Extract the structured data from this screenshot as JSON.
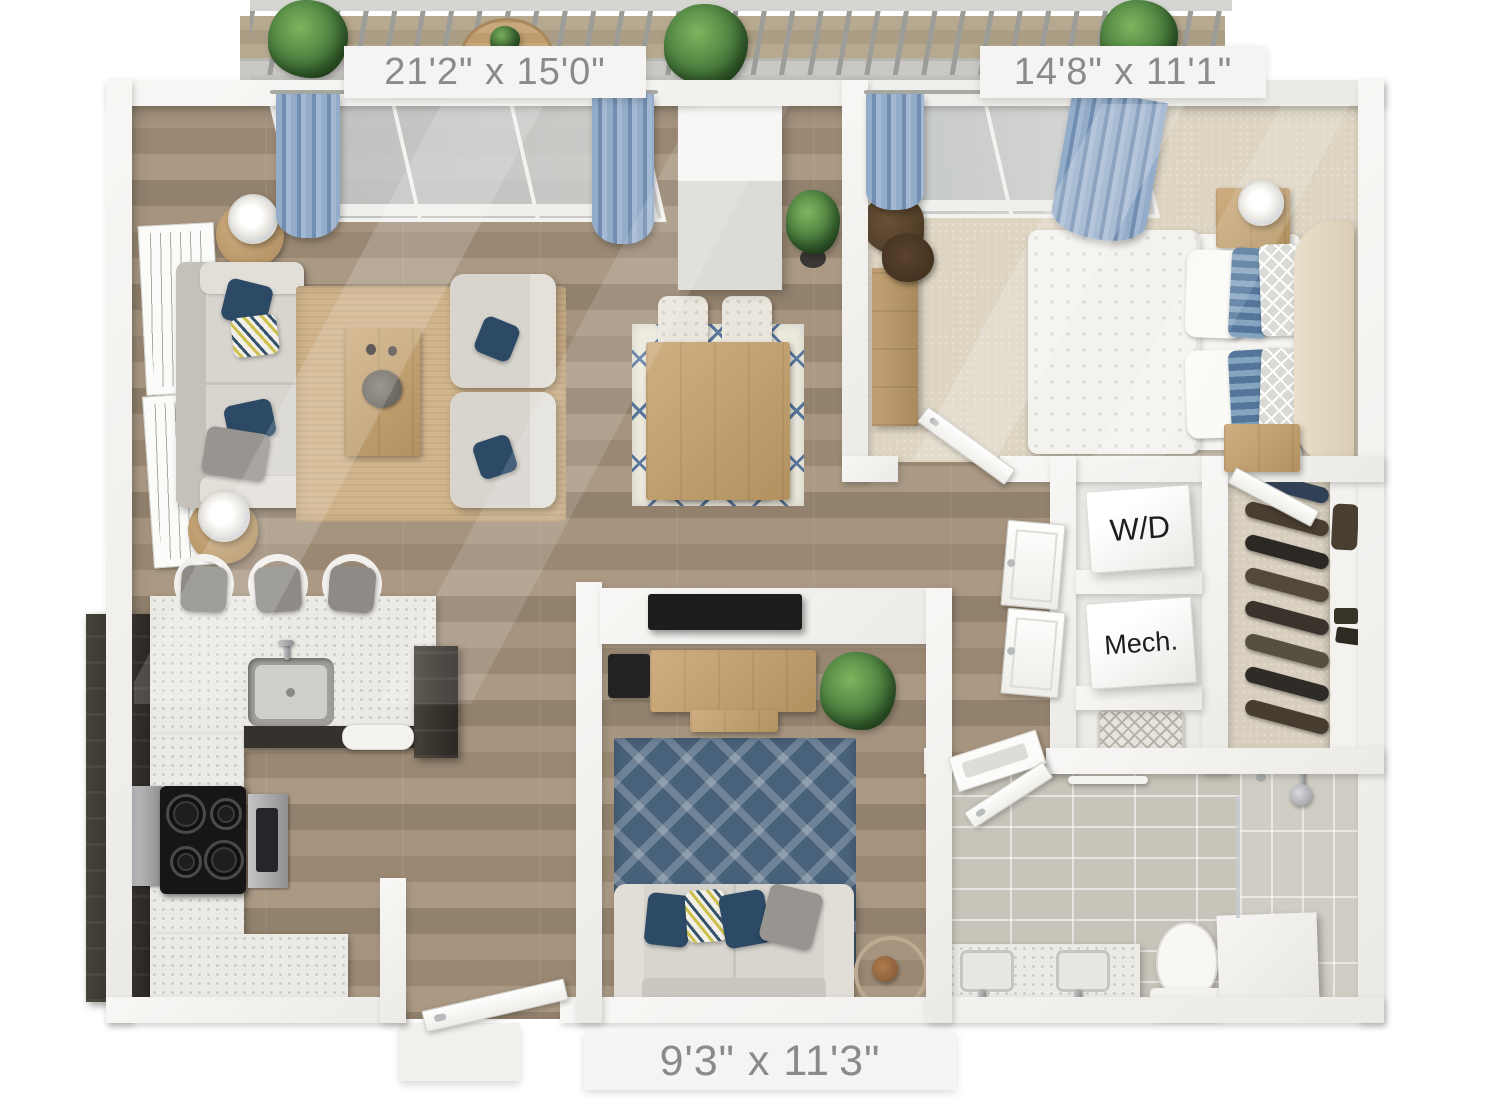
{
  "title": "3D apartment floor plan",
  "labels": {
    "living_room": "21'2\" x 15'0\"",
    "bedroom": "14'8\" x 11'1\"",
    "den": "9'3\" x 11'3\"",
    "washer_dryer": "W/D",
    "mechanical": "Mech."
  },
  "rooms": [
    {
      "name": "balcony",
      "features": [
        "railing",
        "potted-plants",
        "round-table",
        "wood-deck"
      ]
    },
    {
      "name": "living-dining-room",
      "dimensions": "21'2\" x 15'0\"",
      "features": [
        "sofa",
        "armchairs",
        "coffee-table",
        "jute-rug",
        "side-tables-with-lamps",
        "wall-art",
        "dining-table",
        "dining-chairs",
        "dining-rug",
        "sliding-glass-door",
        "blue-curtains",
        "column",
        "potted-plant"
      ]
    },
    {
      "name": "bedroom",
      "dimensions": "14'8\" x 11'1\"",
      "features": [
        "bed",
        "duvet",
        "pillows",
        "headboard",
        "nightstands-with-lamps",
        "dresser",
        "window-with-blue-curtains",
        "carpet"
      ]
    },
    {
      "name": "kitchen",
      "features": [
        "l-shaped-counter",
        "dark-cabinets",
        "sink",
        "faucet",
        "cooktop",
        "oven",
        "dishwasher",
        "bar-stools"
      ]
    },
    {
      "name": "den",
      "dimensions": "9'3\" x 11'3\"",
      "features": [
        "loveseat",
        "blue-trellis-rug",
        "tv",
        "media-console",
        "speaker",
        "potted-plant",
        "floor-lamp"
      ]
    },
    {
      "name": "hallway",
      "features": [
        "bedroom-door",
        "closet-doors"
      ]
    },
    {
      "name": "laundry-closet",
      "label": "W/D"
    },
    {
      "name": "mechanical-closet",
      "label": "Mech."
    },
    {
      "name": "linen-nook",
      "features": [
        "woven-basket"
      ]
    },
    {
      "name": "walk-in-closet",
      "features": [
        "hanging-clothes",
        "shelf",
        "bag",
        "shoes"
      ]
    },
    {
      "name": "bathroom",
      "features": [
        "double-vanity",
        "sinks",
        "toilet",
        "walk-in-shower",
        "shower-head",
        "partition-wall",
        "towel-shelf",
        "towel-bar",
        "tile-floor"
      ]
    },
    {
      "name": "entry",
      "features": [
        "entry-door",
        "door-mat"
      ]
    }
  ],
  "colors": {
    "wall": "#f5f4f1",
    "label_text": "#8a8a8a",
    "text_dark": "#1d1d1d",
    "wood_floor": "#a5937f",
    "carpet": "#ddd4c2",
    "tile": "#c8c4ba",
    "tile_shower": "#d0cdc4",
    "walkin_floor": "#d7cebd",
    "bay_floor": "#edece8",
    "counter": "#eceae5",
    "cabinet_dark": "#3c3833",
    "rug_jute": "#d2b58c",
    "rug_blue": "#48627b",
    "rug_dining": "#ece9dd",
    "rug_dining_line": "#5b79a0",
    "sofa": "#d8d5cf",
    "pillow_navy": "#2c4a66",
    "pillow_gray": "#989590",
    "curtain": "#8ba6c6",
    "plant": "#4f8040",
    "wood_furniture": "#c3a377",
    "headboard": "#e4dac6"
  }
}
